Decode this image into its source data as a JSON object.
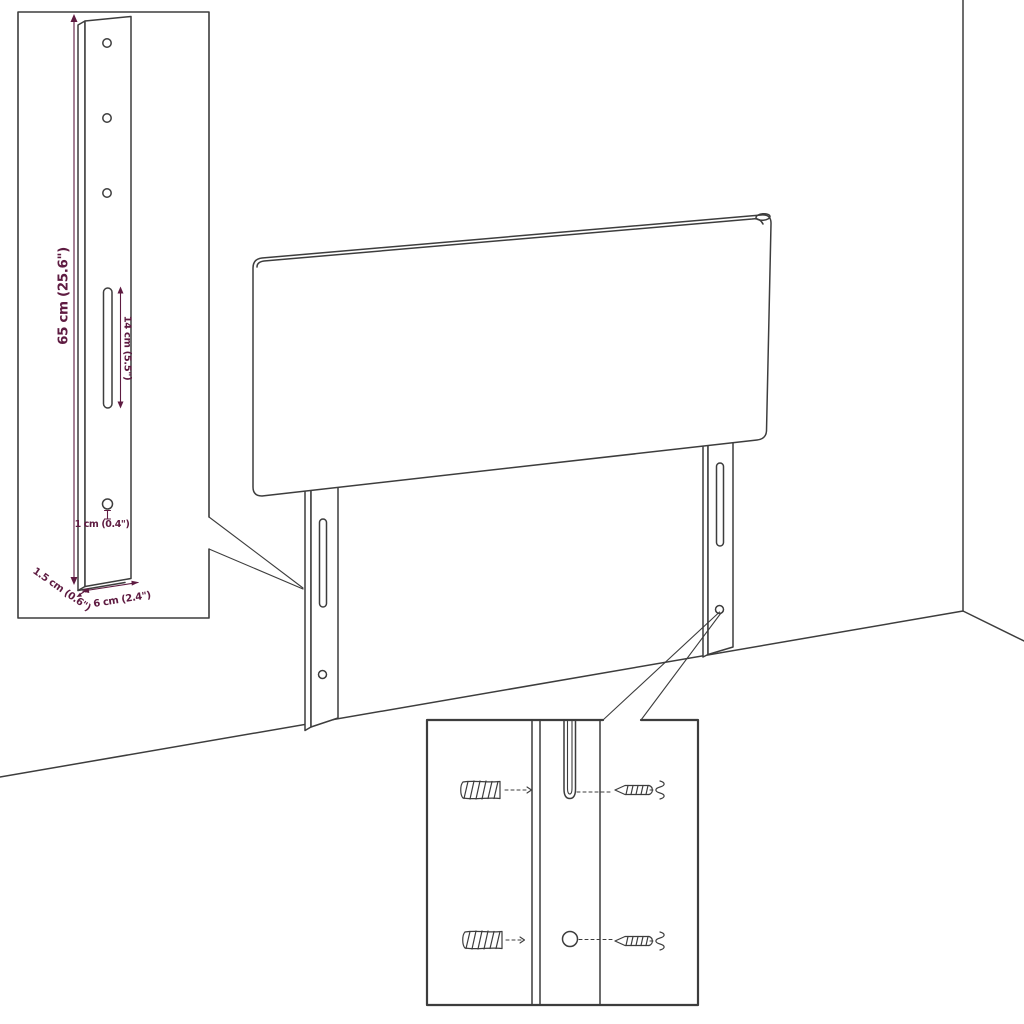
{
  "diagram": {
    "type": "product-dimension-line-drawing",
    "product": "upholstered headboard with two mounting legs",
    "colors": {
      "line_color": "#3d3d3d",
      "dimension_accent": "#5e1b41"
    },
    "insets": {
      "leg_detail": {
        "dimensions": {
          "height": "65 cm (25.6\")",
          "slot_length": "14 cm (5.5\")",
          "hole_offset": "1 cm (0.4\")",
          "thickness": "1.5 cm (0.6\")",
          "width": "6 cm (2.4\")"
        }
      },
      "mounting_detail": {
        "parts": [
          "wall-plug-screw",
          "mounting-screw",
          "slot",
          "round-hole"
        ]
      }
    }
  }
}
